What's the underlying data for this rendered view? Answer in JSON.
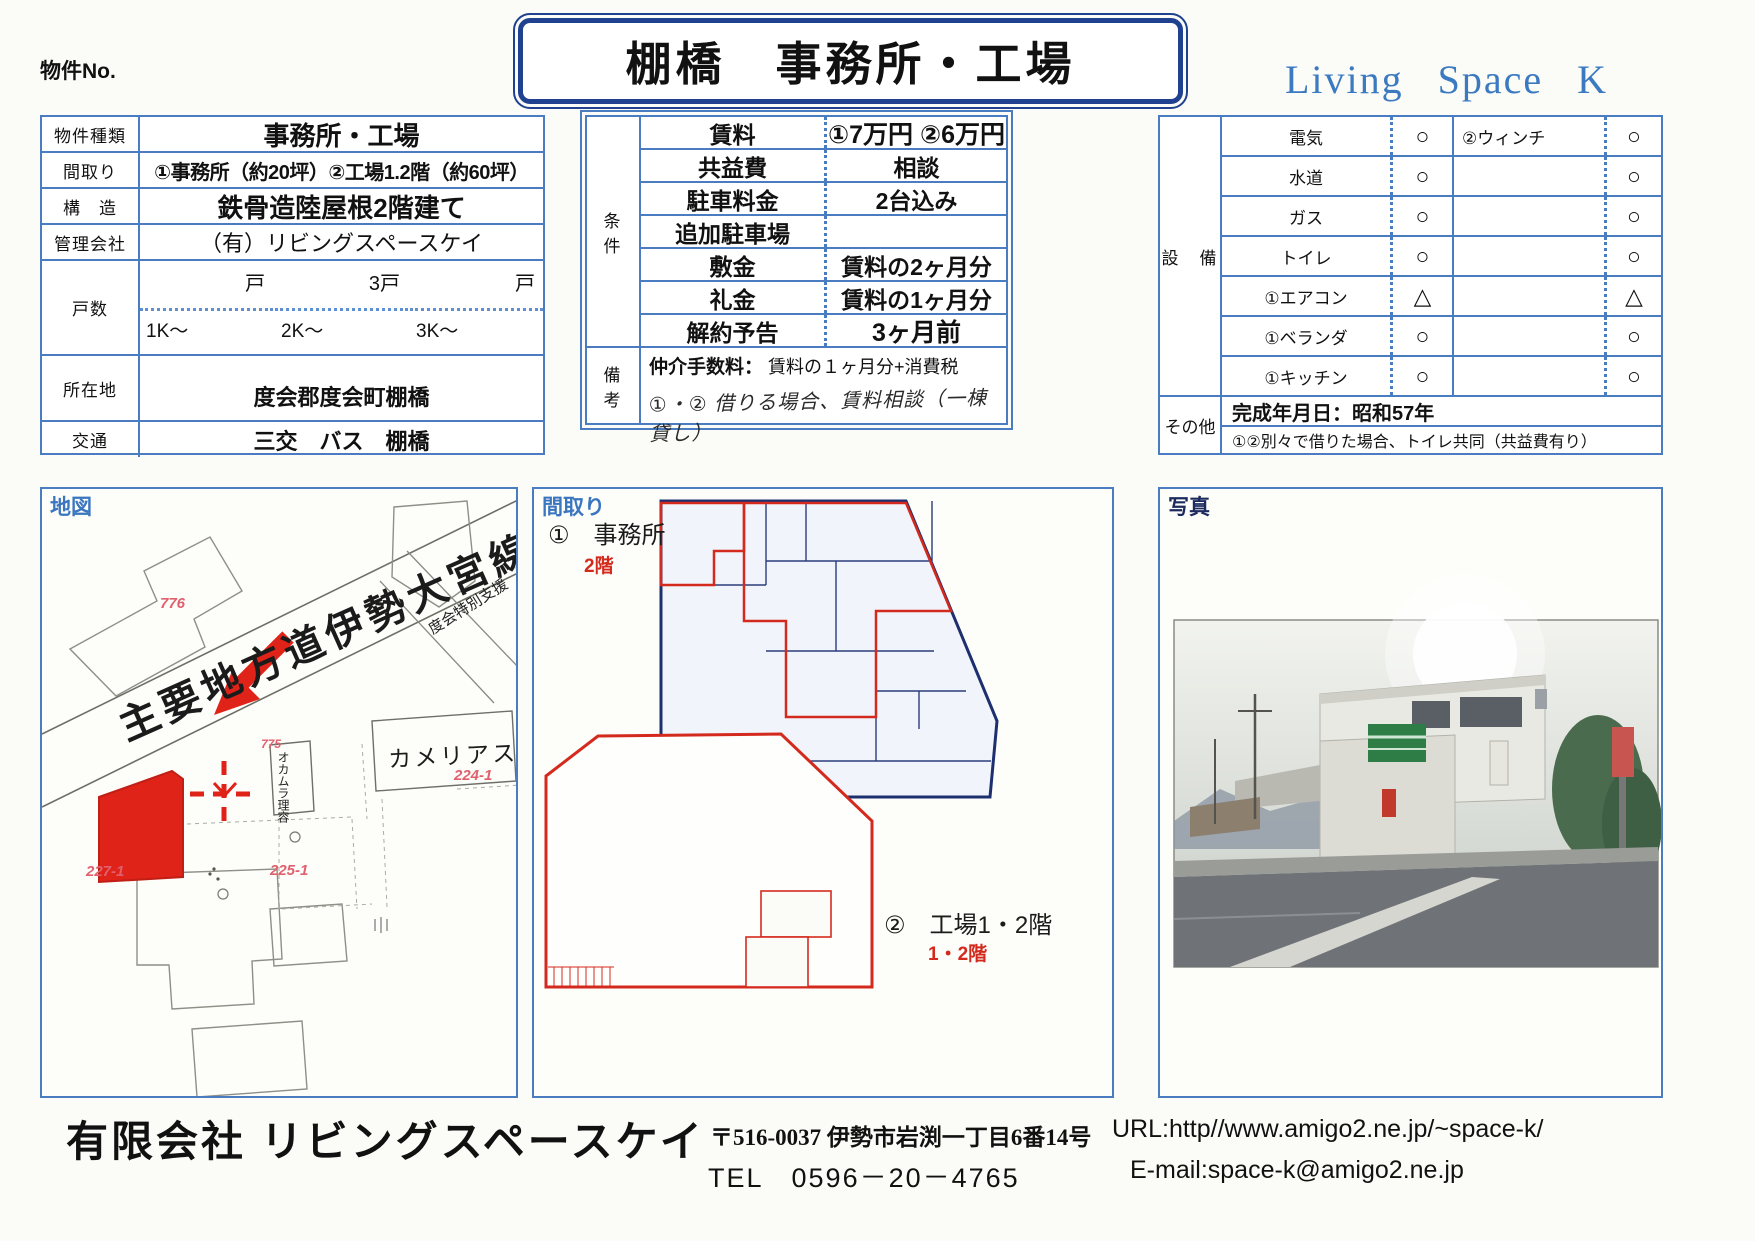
{
  "header": {
    "property_no_label": "物件No.",
    "title": "棚橋　事務所・工場",
    "brand": "Living Space K"
  },
  "property": {
    "rows": [
      {
        "label": "物件種類",
        "value": "事務所・工場"
      },
      {
        "label": "間取り",
        "value": "①事務所（約20坪）②工場1.2階（約60坪）"
      },
      {
        "label": "構　造",
        "value": "鉄骨造陸屋根2階建て"
      },
      {
        "label": "管理会社",
        "value": "（有）リビングスペースケイ"
      }
    ],
    "units": {
      "label": "戸数",
      "cols": [
        {
          "size": "1K～",
          "count": "戸"
        },
        {
          "size": "2K～",
          "count": "3戸"
        },
        {
          "size": "3K～",
          "count": "戸"
        }
      ]
    },
    "location": {
      "label": "所在地",
      "value": "度会郡度会町棚橋"
    },
    "transport": {
      "label": "交通",
      "value": "三交　バス　棚橋"
    }
  },
  "conditions": {
    "label": "条　件",
    "rows": [
      {
        "name": "賃料",
        "value": "①7万円 ②6万円"
      },
      {
        "name": "共益費",
        "value": "相談"
      },
      {
        "name": "駐車料金",
        "value": "2台込み"
      },
      {
        "name": "追加駐車場",
        "value": ""
      },
      {
        "name": "敷金",
        "value": "賃料の2ヶ月分"
      },
      {
        "name": "礼金",
        "value": "賃料の1ヶ月分"
      },
      {
        "name": "解約予告",
        "value": "3ヶ月前"
      }
    ],
    "remarks": {
      "label": "備　考",
      "fee_label": "仲介手数料：",
      "fee_value": "賃料の１ヶ月分+消費税",
      "note": "①・② 借りる場合、賃料相談（一棟貸し）"
    }
  },
  "equipment": {
    "label": "設　備",
    "rows": [
      {
        "name": "電気",
        "mark": "○",
        "name2": "②ウィンチ",
        "mark2": "○"
      },
      {
        "name": "水道",
        "mark": "○",
        "name2": "",
        "mark2": "○"
      },
      {
        "name": "ガス",
        "mark": "○",
        "name2": "",
        "mark2": "○"
      },
      {
        "name": "トイレ",
        "mark": "○",
        "name2": "",
        "mark2": "○"
      },
      {
        "name": "①エアコン",
        "mark": "△",
        "name2": "",
        "mark2": "△"
      },
      {
        "name": "①ベランダ",
        "mark": "○",
        "name2": "",
        "mark2": "○"
      },
      {
        "name": "①キッチン",
        "mark": "○",
        "name2": "",
        "mark2": "○"
      }
    ],
    "other": {
      "label": "その他",
      "line1": "完成年月日：昭和57年",
      "line2": "①②別々で借りた場合、トイレ共同（共益費有り）"
    }
  },
  "map": {
    "header": "地図",
    "road_name": "主要地方道伊勢大宮線",
    "road_name2": "度会特別支援",
    "camellia": "カメリアス",
    "barber": "オカムラ理容",
    "parcels": {
      "p776": "776",
      "p775": "775",
      "p224": "224-1",
      "p225": "225-1",
      "p227": "227-1"
    }
  },
  "floorplan": {
    "header": "間取り",
    "unit1": "①　事務所",
    "unit1_floor": "2階",
    "unit2": "②　工場1・2階",
    "unit2_floor": "1・2階"
  },
  "photo": {
    "header": "写真"
  },
  "footer": {
    "company": "有限会社 リビングスペースケイ",
    "address": "〒516-0037 伊勢市岩渕一丁目6番14号",
    "tel": "TEL　0596－20－4765",
    "url": "URL:http//www.amigo2.ne.jp/~space-k/",
    "email": "E-mail:space-k@amigo2.ne.jp"
  },
  "colors": {
    "table_border": "#4a7cc2",
    "title_border": "#20418f",
    "brand_blue": "#3b7ac1",
    "accent_red": "#d42a1e",
    "parcel_pink": "#e0606e"
  }
}
